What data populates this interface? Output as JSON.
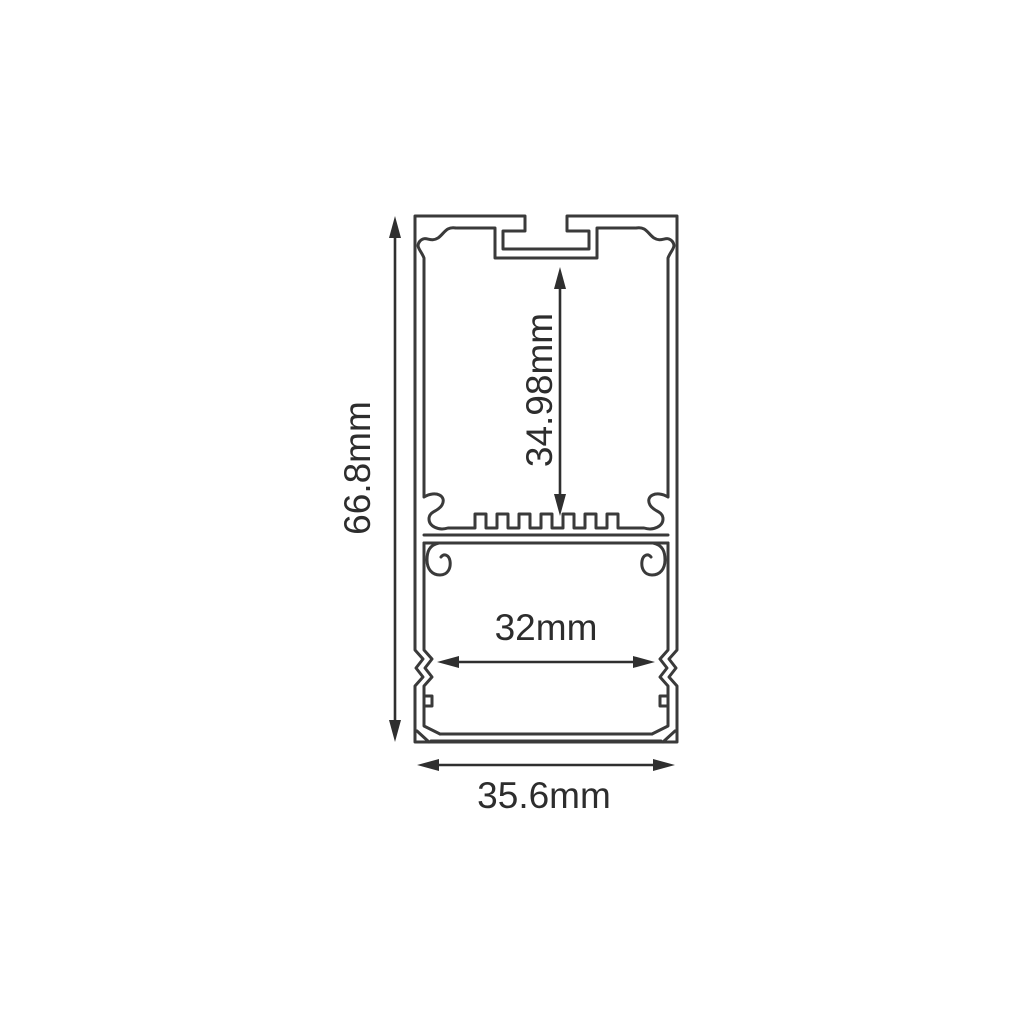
{
  "page": {
    "background_color": "#ffffff"
  },
  "drawing": {
    "kind": "profile-cross-section-diagram",
    "line_color": "#3a3a3a",
    "dimension_color": "#2f2f2f",
    "text_color": "#2d2d2d",
    "dimensions": {
      "overall_height": "66.8mm",
      "inner_height": "34.98mm",
      "inner_width": "32mm",
      "overall_width": "35.6mm"
    }
  }
}
